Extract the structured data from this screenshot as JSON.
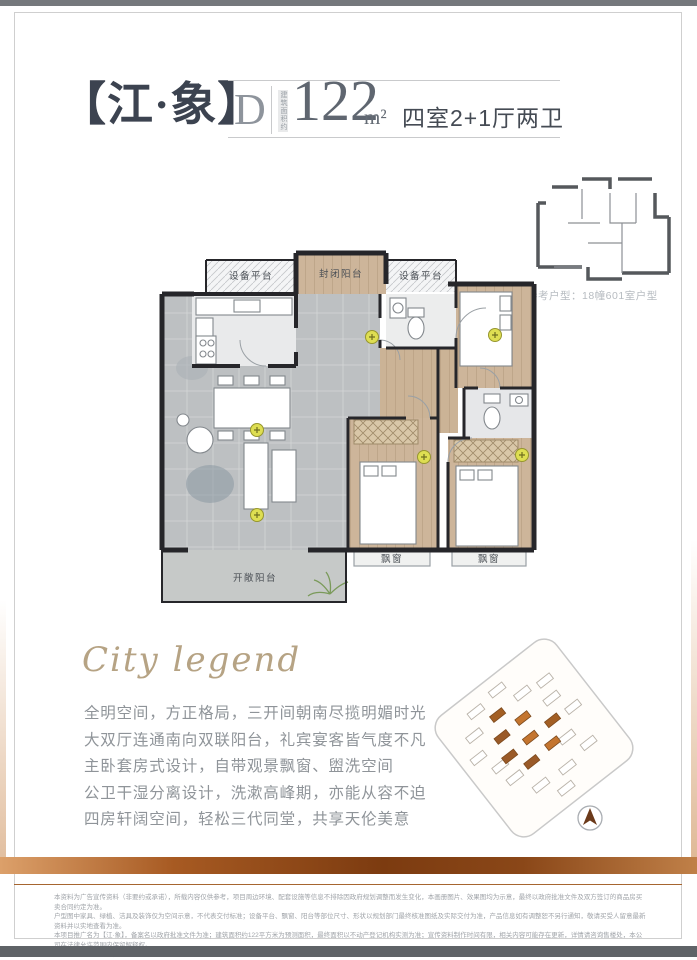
{
  "header": {
    "project_name": "【江·象】",
    "unit_letter": "D",
    "area_prefix_vertical": "建筑面积约",
    "area_value": "122",
    "area_unit": "m²",
    "room_config": "四室2+1厅两卫"
  },
  "reference_plan": {
    "caption": "参考户型：18幢601室户型"
  },
  "floor_plan": {
    "labels": {
      "equipment_platform_left": "设备平台",
      "enclosed_balcony": "封闭阳台",
      "equipment_platform_right": "设备平台",
      "open_balcony": "开敞阳台",
      "bay_window_left": "飘窗",
      "bay_window_right": "飘窗"
    }
  },
  "tagline": "City legend",
  "description_lines": [
    "全明空间，方正格局，三开间朝南尽揽明媚时光",
    "大双厅连通南向双联阳台，礼宾宴客皆气度不凡",
    "主卧套房式设计，自带观景飘窗、盥洗空间",
    "公卫干湿分离设计，洗漱高峰期，亦能从容不迫",
    "四房轩阔空间，轻松三代同堂，共享天伦美意"
  ],
  "disclaimer_lines": [
    "本资料为广告宣传资料（非要约或承诺），所载内容仅供参考，项目周边环境、配套设施等信息不排除因政府规划调整而发生变化，本画册图片、效果图均为示意，最终以政府批准文件及双方签订的商品房买卖合同约定为准。",
    "户型图中家具、绿植、洁具及装饰仅为空间示意，不代表交付标准；设备平台、飘窗、阳台等部位尺寸、形状以规划部门最终核准图纸及实际交付为准，产品信息如有调整恕不另行通知，敬请买受人留意最新资料并以实地查看为准。",
    "本项目推广名为【江·象】，备案名以政府批准文件为准；建筑面积约122平方米为预测面积，最终面积以不动产登记机构实测为准；宣传资料制作时间有限，相关内容可能存在更新，详情请咨询售楼处，本公司在法律允许范围内保留解释权。",
    "欢迎莅临售楼处品鉴，置业顾问将为您提供详细咨询服务。"
  ],
  "site_plan": {
    "compass": "north-arrow"
  },
  "colors": {
    "accent_brown": "#7c3b10",
    "accent_gold": "#b6a384",
    "title_text": "#3c4350",
    "wall": "#26262a",
    "wood_floor": "#cdb59a",
    "stone_floor": "#bdc0c2",
    "symbol_yellow": "#dede52"
  }
}
